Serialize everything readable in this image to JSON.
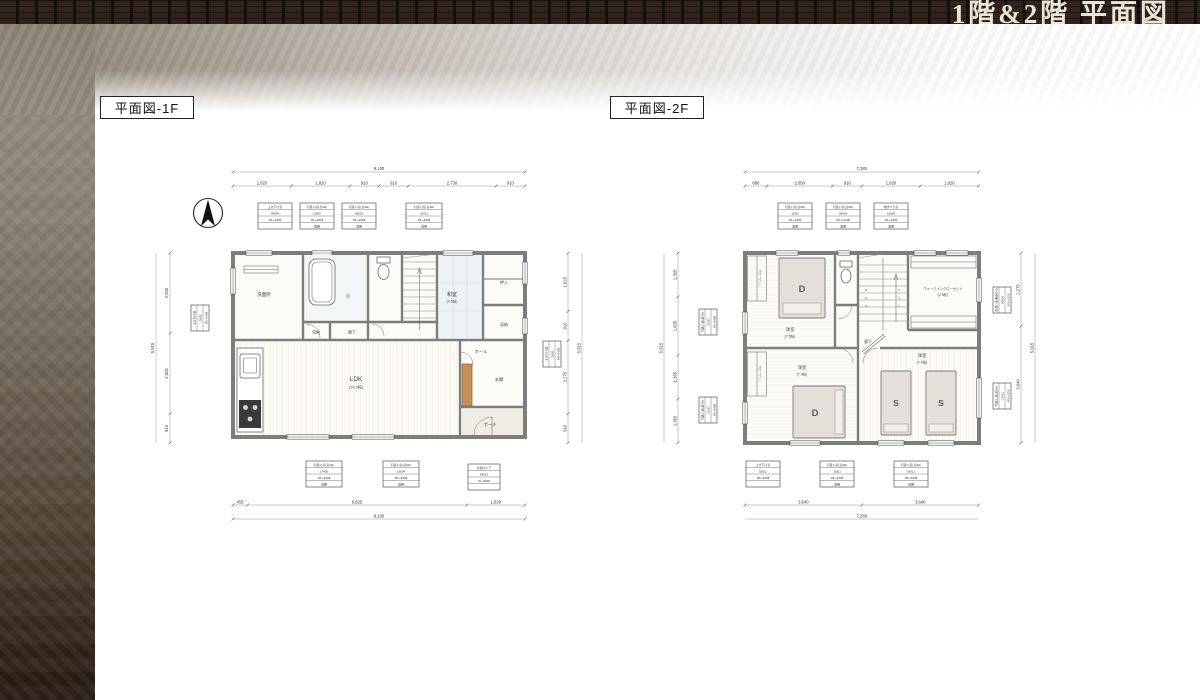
{
  "header": {
    "title": "1階&2階 平面図"
  },
  "plan1f": {
    "label": "平面図-1F",
    "rooms": {
      "senmenjo": "洗面所",
      "shuno1": "収納",
      "rouka": "廊下",
      "washitsu": "和室",
      "washitsu_size": "(4.5帖)",
      "oshiire": "押入",
      "shuno2": "収納",
      "ldk": "LDK",
      "ldk_size": "(14.0帖)",
      "hall": "ホール",
      "genkan": "玄関",
      "porch": "ポーチ"
    },
    "dims": {
      "top_total": "9,100",
      "top": [
        "1,820",
        "1,820",
        "910",
        "910",
        "2,730",
        "910"
      ],
      "bottom": [
        "455",
        "6,825",
        "1,820"
      ],
      "bottom_total": "9,100",
      "left": [
        "2,500",
        "2,505",
        "910"
      ],
      "left_total": "5,915",
      "right": [
        "1,820",
        "910",
        "2,275",
        "910"
      ],
      "right_total": "5,915"
    },
    "tables_top": [
      [
        "上げ下げ窓",
        "06009",
        "IPL+9408",
        ""
      ],
      [
        "引違い窓(窓SH)",
        "11405",
        "IPL+9408",
        "透明"
      ],
      [
        "引違い窓(窓SH)",
        "06003",
        "IPL+9408",
        "透明"
      ],
      [
        "引違い窓(窓SH)",
        "16011",
        "IPL+9408",
        "透明"
      ]
    ],
    "tables_bottom": [
      [
        "引違い窓(窓SH)",
        "17405",
        "IPL+9408",
        "透明"
      ],
      [
        "引違い窓(窓SH)",
        "16004",
        "IPL+9408",
        "透明"
      ],
      [
        "片開きドア",
        "08023",
        "(7L-4000)",
        ""
      ]
    ],
    "table_left": [
      "上げ下げ窓",
      "0609",
      "IPL+9408"
    ],
    "table_right": [
      "上げ下げ窓",
      "0609",
      "IPL+9408"
    ]
  },
  "plan2f": {
    "label": "平面図-2F",
    "rooms": {
      "yoshitsu1": "洋室",
      "yoshitsu1_size": "(7.5帖)",
      "yoshitsu2": "洋室",
      "yoshitsu2_size": "(7.4帖)",
      "yoshitsu3": "洋室",
      "yoshitsu3_size": "(7.7帖)",
      "rouka": "廊下",
      "wic": "ウォークインクローゼット",
      "wic_size": "(2.5帖)",
      "closet1": "クローゼット",
      "closet2": "クローゼット"
    },
    "beds": {
      "d1": "D",
      "d2": "D",
      "s1": "S",
      "s2": "S"
    },
    "stairs": [
      "11",
      "12",
      "13",
      "5",
      "4",
      "3"
    ],
    "dims": {
      "top_total": "7,280",
      "top": [
        "680",
        "2,050",
        "910",
        "1,820",
        "1,820"
      ],
      "bottom": [
        "3,640",
        "3,640"
      ],
      "bottom_total": "7,280",
      "left": [
        "1,365",
        "1,820",
        "1,365",
        "1,365"
      ],
      "left_total": "5,915",
      "right": [
        "2,275",
        "3,640"
      ],
      "right_total": "5,915"
    },
    "tables_top": [
      [
        "引違い窓(窓SH)",
        "11911",
        "IPL+9408",
        "透明"
      ],
      [
        "引違い窓(窓SH)",
        "06009",
        "IPL+11408",
        "透明"
      ],
      [
        "縦すべり窓",
        "16009",
        "IPL+9408",
        "透明"
      ]
    ],
    "tables_bottom": [
      [
        "上げ下げ窓",
        "02611",
        "IPL+9408",
        ""
      ],
      [
        "引違い窓(窓SH)",
        "11911",
        "IPL+9408",
        "透明"
      ],
      [
        "引違い窓(窓SH)",
        "16011",
        "IPL+9408",
        "透明"
      ]
    ],
    "tables_left": [
      [
        "引違い窓(窓SH)",
        "16011",
        "IPL+9408"
      ],
      [
        "引違い窓(窓SH)",
        "11011",
        "IPL+9408"
      ]
    ],
    "tables_right": [
      [
        "引違い窓(断熱SH)",
        "06903",
        "9PL+1150"
      ],
      [
        "引違い窓(窓SH)",
        "11611",
        "4PL+1150"
      ]
    ]
  }
}
